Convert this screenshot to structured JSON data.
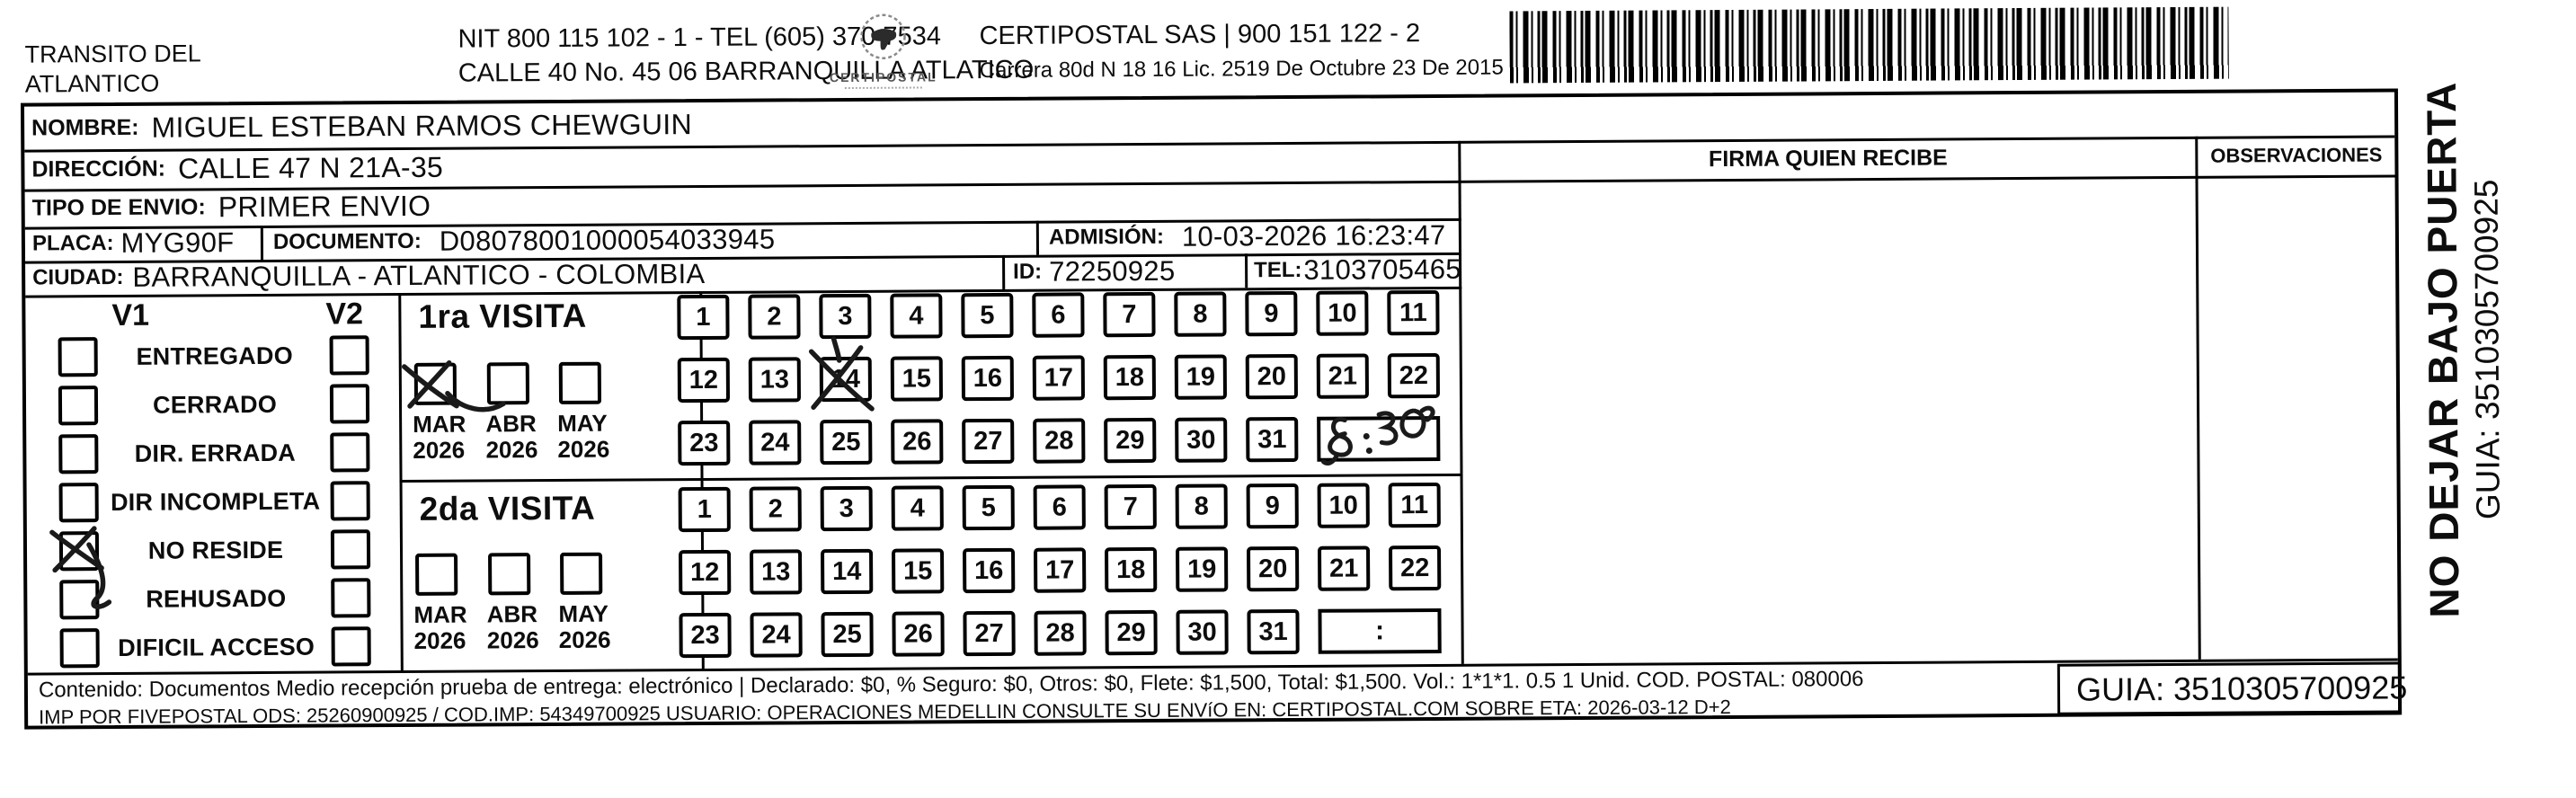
{
  "header": {
    "sender_name": "TRANSITO DEL\nATLANTICO",
    "nit_tel": "NIT 800 115 102 - 1 - TEL (605) 370 7534",
    "sender_address": "CALLE 40 No. 45 06 BARRANQUILLA ATLATICO",
    "logo_name": "CERTIPOSTAL",
    "operator": "CERTIPOSTAL SAS | 900 151 122 - 2",
    "operator_address": "Carrera 80d N 18 16  Lic. 2519 De Octubre 23 De 2015"
  },
  "shipment": {
    "nombre_label": "NOMBRE:",
    "nombre": "MIGUEL ESTEBAN RAMOS CHEWGUIN",
    "direccion_label": "DIRECCIÓN:",
    "direccion": "CALLE 47 N 21A-35",
    "tipo_envio_label": "TIPO DE ENVIO:",
    "tipo_envio": "PRIMER ENVIO",
    "placa_label": "PLACA:",
    "placa": "MYG90F",
    "documento_label": "DOCUMENTO:",
    "documento": "D08078001000054033945",
    "admision_label": "ADMISIÓN:",
    "admision": "10-03-2026 16:23:47",
    "ciudad_label": "CIUDAD:",
    "ciudad": "BARRANQUILLA - ATLANTICO - COLOMBIA",
    "id_label": "ID:",
    "id": "72250925",
    "tel_label": "TEL:",
    "tel": "3103705465"
  },
  "status_panel": {
    "col1_header": "V1",
    "col2_header": "V2",
    "options": [
      "ENTREGADO",
      "CERRADO",
      "DIR. ERRADA",
      "DIR INCOMPLETA",
      "NO RESIDE",
      "REHUSADO",
      "DIFICIL ACCESO"
    ],
    "v1_checked_option": "NO RESIDE",
    "v2_checked_option": null
  },
  "visits": {
    "first": {
      "title": "1ra VISITA",
      "months": [
        {
          "label": "MAR\n2026"
        },
        {
          "label": "ABR\n2026"
        },
        {
          "label": "MAY\n2026"
        }
      ],
      "checked_month": "MAR 2026",
      "days": [
        1,
        2,
        3,
        4,
        5,
        6,
        7,
        8,
        9,
        10,
        11,
        12,
        13,
        14,
        15,
        16,
        17,
        18,
        19,
        20,
        21,
        22,
        23,
        24,
        25,
        26,
        27,
        28,
        29,
        30,
        31
      ],
      "crossed_day": 14,
      "time_annotation": "8:30",
      "time_placeholder": ""
    },
    "second": {
      "title": "2da VISITA",
      "months": [
        {
          "label": "MAR\n2026"
        },
        {
          "label": "ABR\n2026"
        },
        {
          "label": "MAY\n2026"
        }
      ],
      "checked_month": null,
      "days": [
        1,
        2,
        3,
        4,
        5,
        6,
        7,
        8,
        9,
        10,
        11,
        12,
        13,
        14,
        15,
        16,
        17,
        18,
        19,
        20,
        21,
        22,
        23,
        24,
        25,
        26,
        27,
        28,
        29,
        30,
        31
      ],
      "crossed_day": null,
      "time_annotation": "",
      "time_placeholder": ":"
    }
  },
  "delivery_panel": {
    "firma_header": "FIRMA QUIEN RECIBE",
    "observaciones_header": "OBSERVACIONES"
  },
  "side_label": {
    "warning": "NO DEJAR BAJO PUERTA",
    "guia": "GUIA: 3510305700925"
  },
  "footer": {
    "content_line": "Contenido: Documentos Medio recepción prueba de entrega: electrónico | Declarado: $0, % Seguro: $0, Otros: $0, Flete: $1,500, Total: $1,500. Vol.: 1*1*1. 0.5  1 Unid. COD. POSTAL: 080006",
    "imp_line": "IMP POR FIVEPOSTAL ODS: 25260900925 / COD.IMP: 54349700925 USUARIO: OPERACIONES MEDELLIN CONSULTE SU ENVíO EN: CERTIPOSTAL.COM SOBRE ETA: 2026-03-12 D+2",
    "guia_label": "GUIA: 3510305700925"
  }
}
